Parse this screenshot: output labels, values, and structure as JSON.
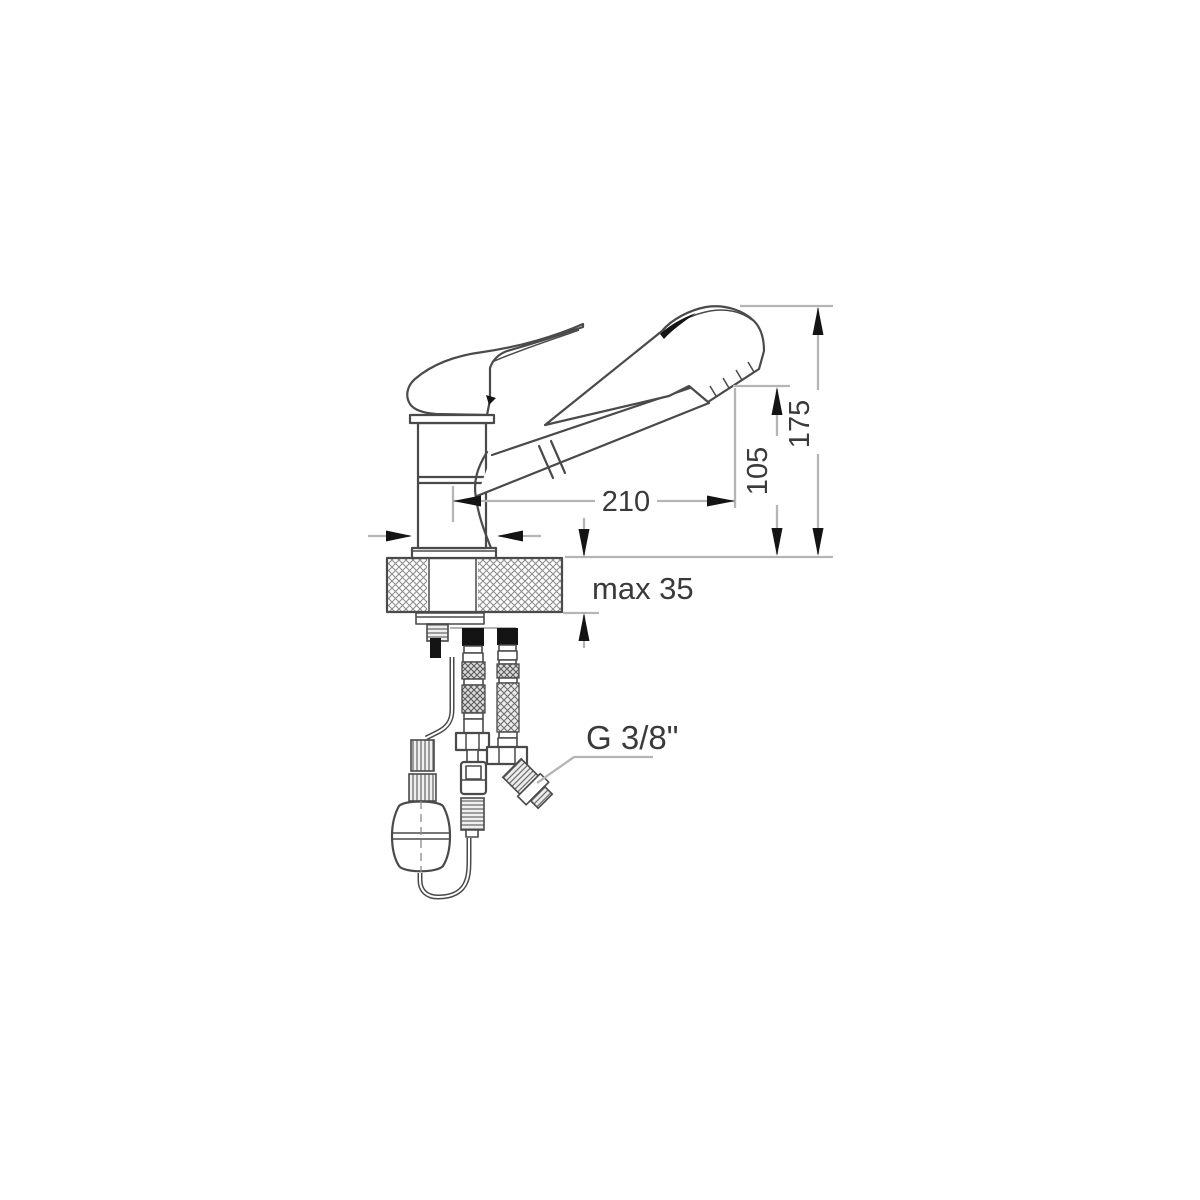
{
  "diagram": {
    "kind": "technical-installation-drawing",
    "subject": "single-lever-mixer-tap-with-pull-out-spray",
    "labels": {
      "dim_spout_reach": "210",
      "dim_spout_height": "105",
      "dim_total_height": "175",
      "dim_deck_thickness": "max 35",
      "thread_size": "G 3/8\""
    },
    "colors": {
      "outline": "#4a4a4a",
      "dim_line": "#b5b5b5",
      "arrow": "#141414",
      "label_text": "#3a3a3a",
      "hatch_line": "#8d8d8d",
      "solid_black": "#141414",
      "background": "#ffffff"
    }
  }
}
